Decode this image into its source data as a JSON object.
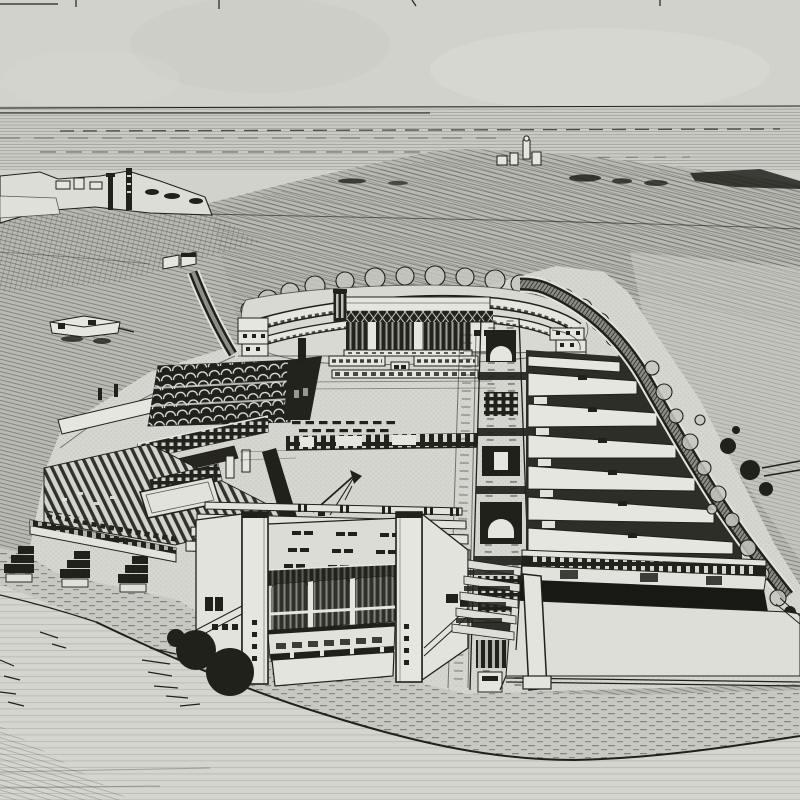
{
  "artwork": {
    "kind": "monochrome ink perspective rendering (halftone reproduction)",
    "description": "Aerial perspective drawing of a waterfront industrial factory complex: an oval stadium-like grandstand at the top of the site, barrel-vaulted and sawtooth factory sheds on the left, large flat-roofed halls in the centre crossed by a vertical conveyor spine, rows of parallel halls on the right bounded by a tree-lined perimeter road, a large glazed assembly hall in the foreground with dark bushes, hatched coastal fields and the sea on the horizon, and a blank paved apron in the foreground.",
    "visible_text": "",
    "regions": [
      "sky",
      "sea",
      "coastline",
      "headland",
      "hatched-fields",
      "farm-buildings",
      "entrance-road",
      "stadium-grandstand",
      "tree-band",
      "left-factory-block",
      "barrel-vault-sheds",
      "central-flat-halls",
      "crane-mast",
      "conveyor-spine",
      "right-hall-rows",
      "perimeter-road",
      "embankment-shrubs",
      "main-foreground-hall",
      "glazed-facade",
      "pylons",
      "bushes",
      "right-long-hall",
      "loading-apron",
      "foreground-ground"
    ]
  },
  "palette": {
    "paper": "#d2d2cd",
    "paper_light": "#dadad5",
    "ink": "#21211c",
    "ink_soft": "#3a3a34",
    "building_white": "#e6e6e1",
    "field_gray": "#b7b7b1",
    "dark_fill": "#23231e",
    "shadow": "#181814"
  }
}
